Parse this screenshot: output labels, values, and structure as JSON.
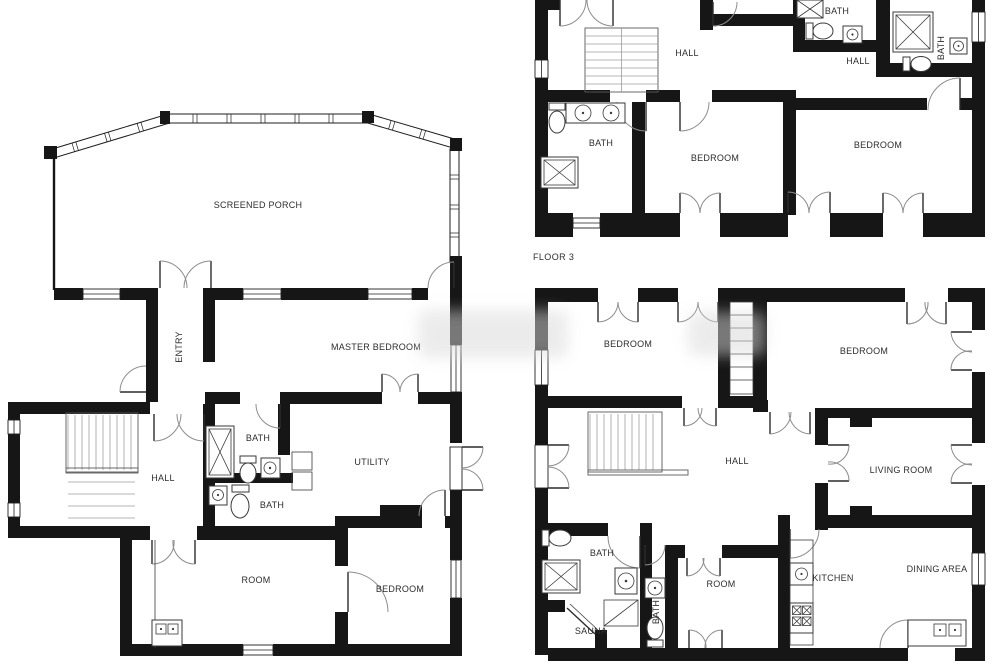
{
  "colors": {
    "wall": "#161616",
    "background": "#ffffff",
    "label": "#2d2d2d",
    "watermark": "#d9d9d9"
  },
  "plans": {
    "left": {
      "rooms": {
        "screened_porch": "SCREENED PORCH",
        "entry": "ENTRY",
        "master_bedroom": "MASTER BEDROOM",
        "bath_upper": "BATH",
        "hall": "HALL",
        "utility": "UTILITY",
        "bath_lower": "BATH",
        "room": "ROOM",
        "bedroom": "BEDROOM"
      }
    },
    "floor3": {
      "caption": "FLOOR 3",
      "rooms": {
        "hall": "HALL",
        "bath_top": "BATH",
        "hall_right": "HALL",
        "bath_right": "BATH",
        "bath_left": "BATH",
        "bedroom_center": "BEDROOM",
        "bedroom_right": "BEDROOM"
      }
    },
    "floor2": {
      "rooms": {
        "bedroom_left": "BEDROOM",
        "bedroom_right": "BEDROOM",
        "hall": "HALL",
        "living_room": "LIVING ROOM",
        "bath": "BATH",
        "room": "ROOM",
        "kitchen": "KITCHEN",
        "dining_area": "DINING AREA",
        "sauna": "SAUNA",
        "bath_small": "BATH"
      }
    }
  }
}
